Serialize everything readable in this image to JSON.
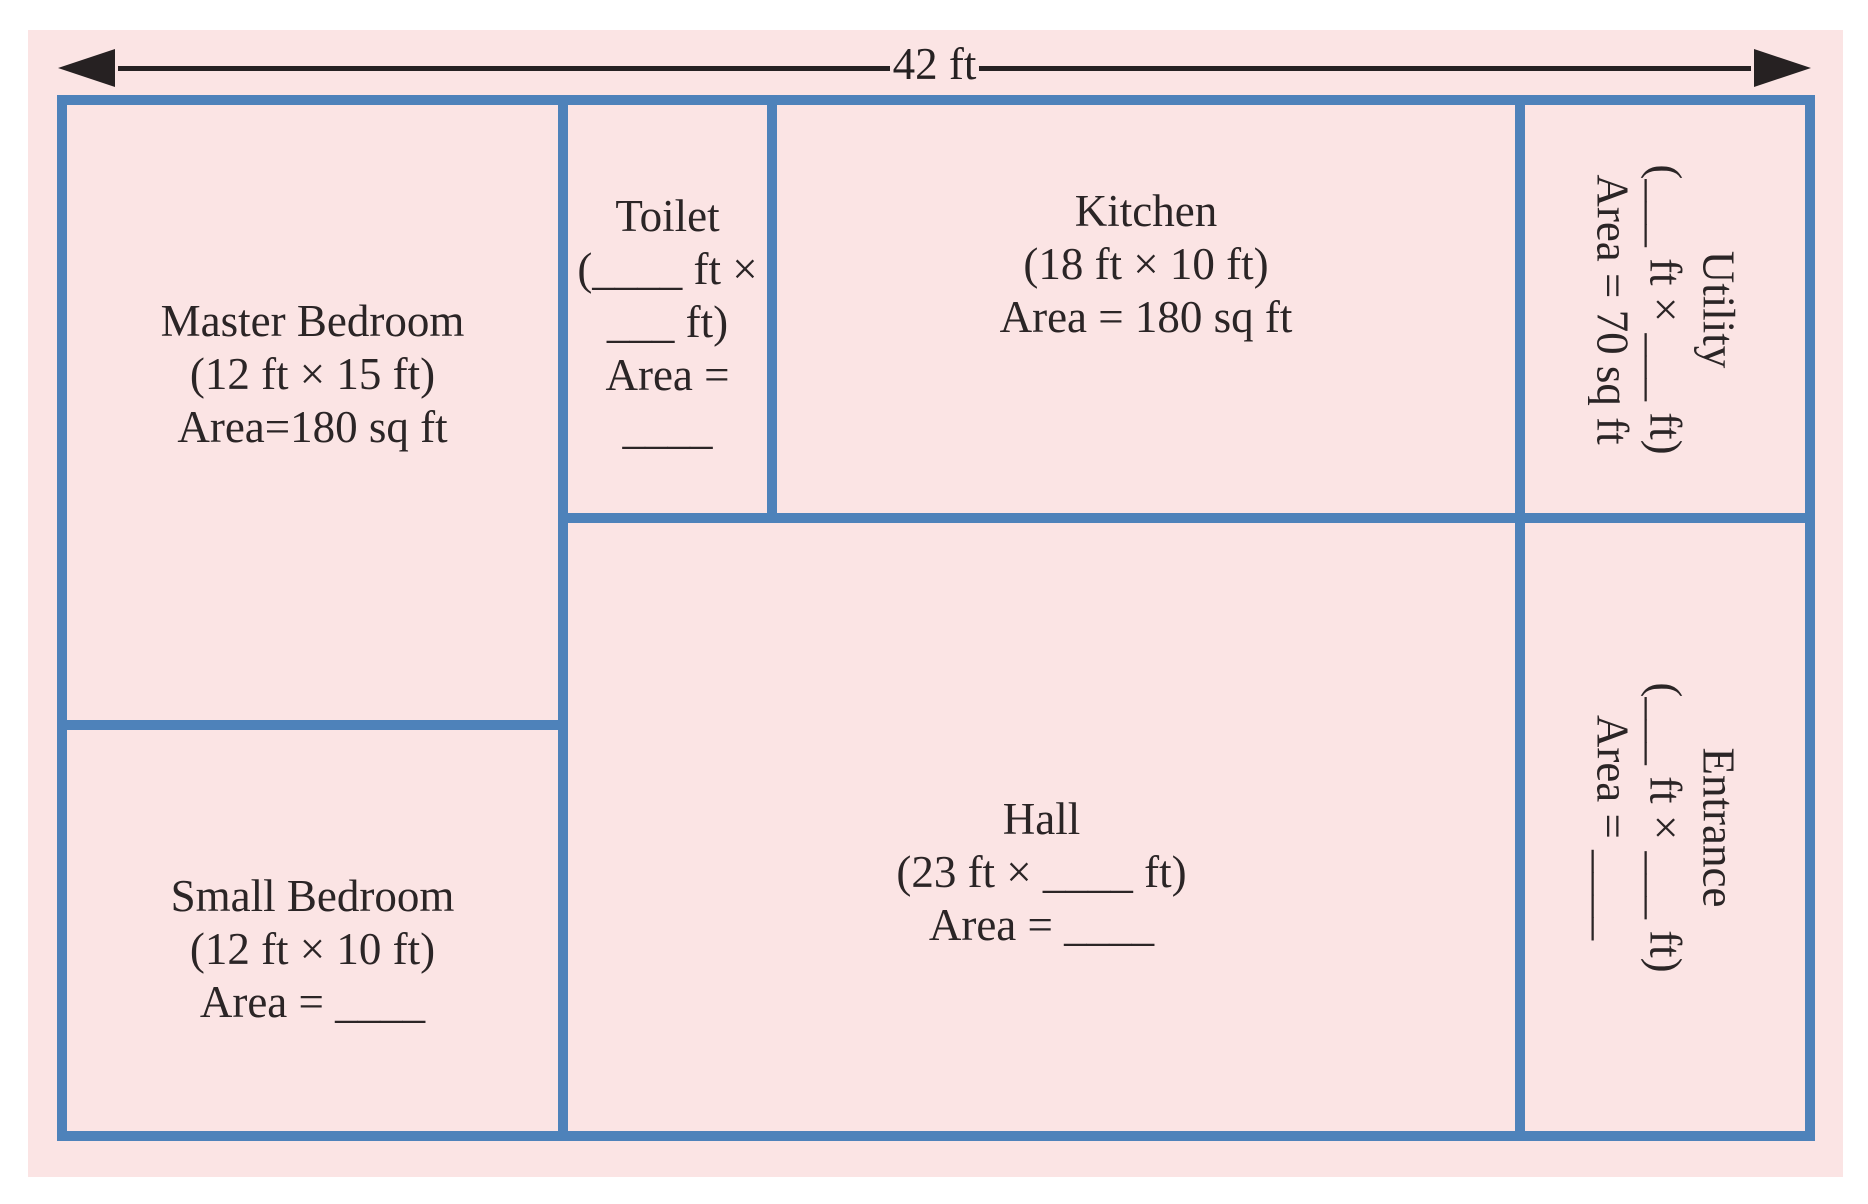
{
  "dimension": {
    "label": "42 ft"
  },
  "colors": {
    "page_background": "#ffffff",
    "panel_background": "#fbe4e4",
    "wall": "#4e82ba",
    "text": "#2b2526",
    "arrow": "#262122"
  },
  "rooms": {
    "master_bedroom": {
      "lines": [
        "Master Bedroom",
        "(12 ft × 15 ft)",
        "Area=180 sq ft"
      ]
    },
    "toilet": {
      "lines": [
        "Toilet",
        "(____ ft ×",
        "___ ft)",
        "Area =",
        "____"
      ]
    },
    "kitchen": {
      "lines": [
        "Kitchen",
        "(18 ft × 10 ft)",
        "Area = 180 sq ft"
      ]
    },
    "utility": {
      "lines": [
        "Utility",
        "(___ ft × ___ ft)",
        "Area = 70 sq ft"
      ]
    },
    "small_bedroom": {
      "lines": [
        "Small Bedroom",
        "(12 ft × 10 ft)",
        "Area = ____"
      ]
    },
    "hall": {
      "lines": [
        "Hall",
        "(23 ft × ____ ft)",
        "Area = ____"
      ]
    },
    "entrance": {
      "lines": [
        "Entrance",
        "(___ ft × ___ ft)",
        "Area = ____"
      ]
    }
  }
}
